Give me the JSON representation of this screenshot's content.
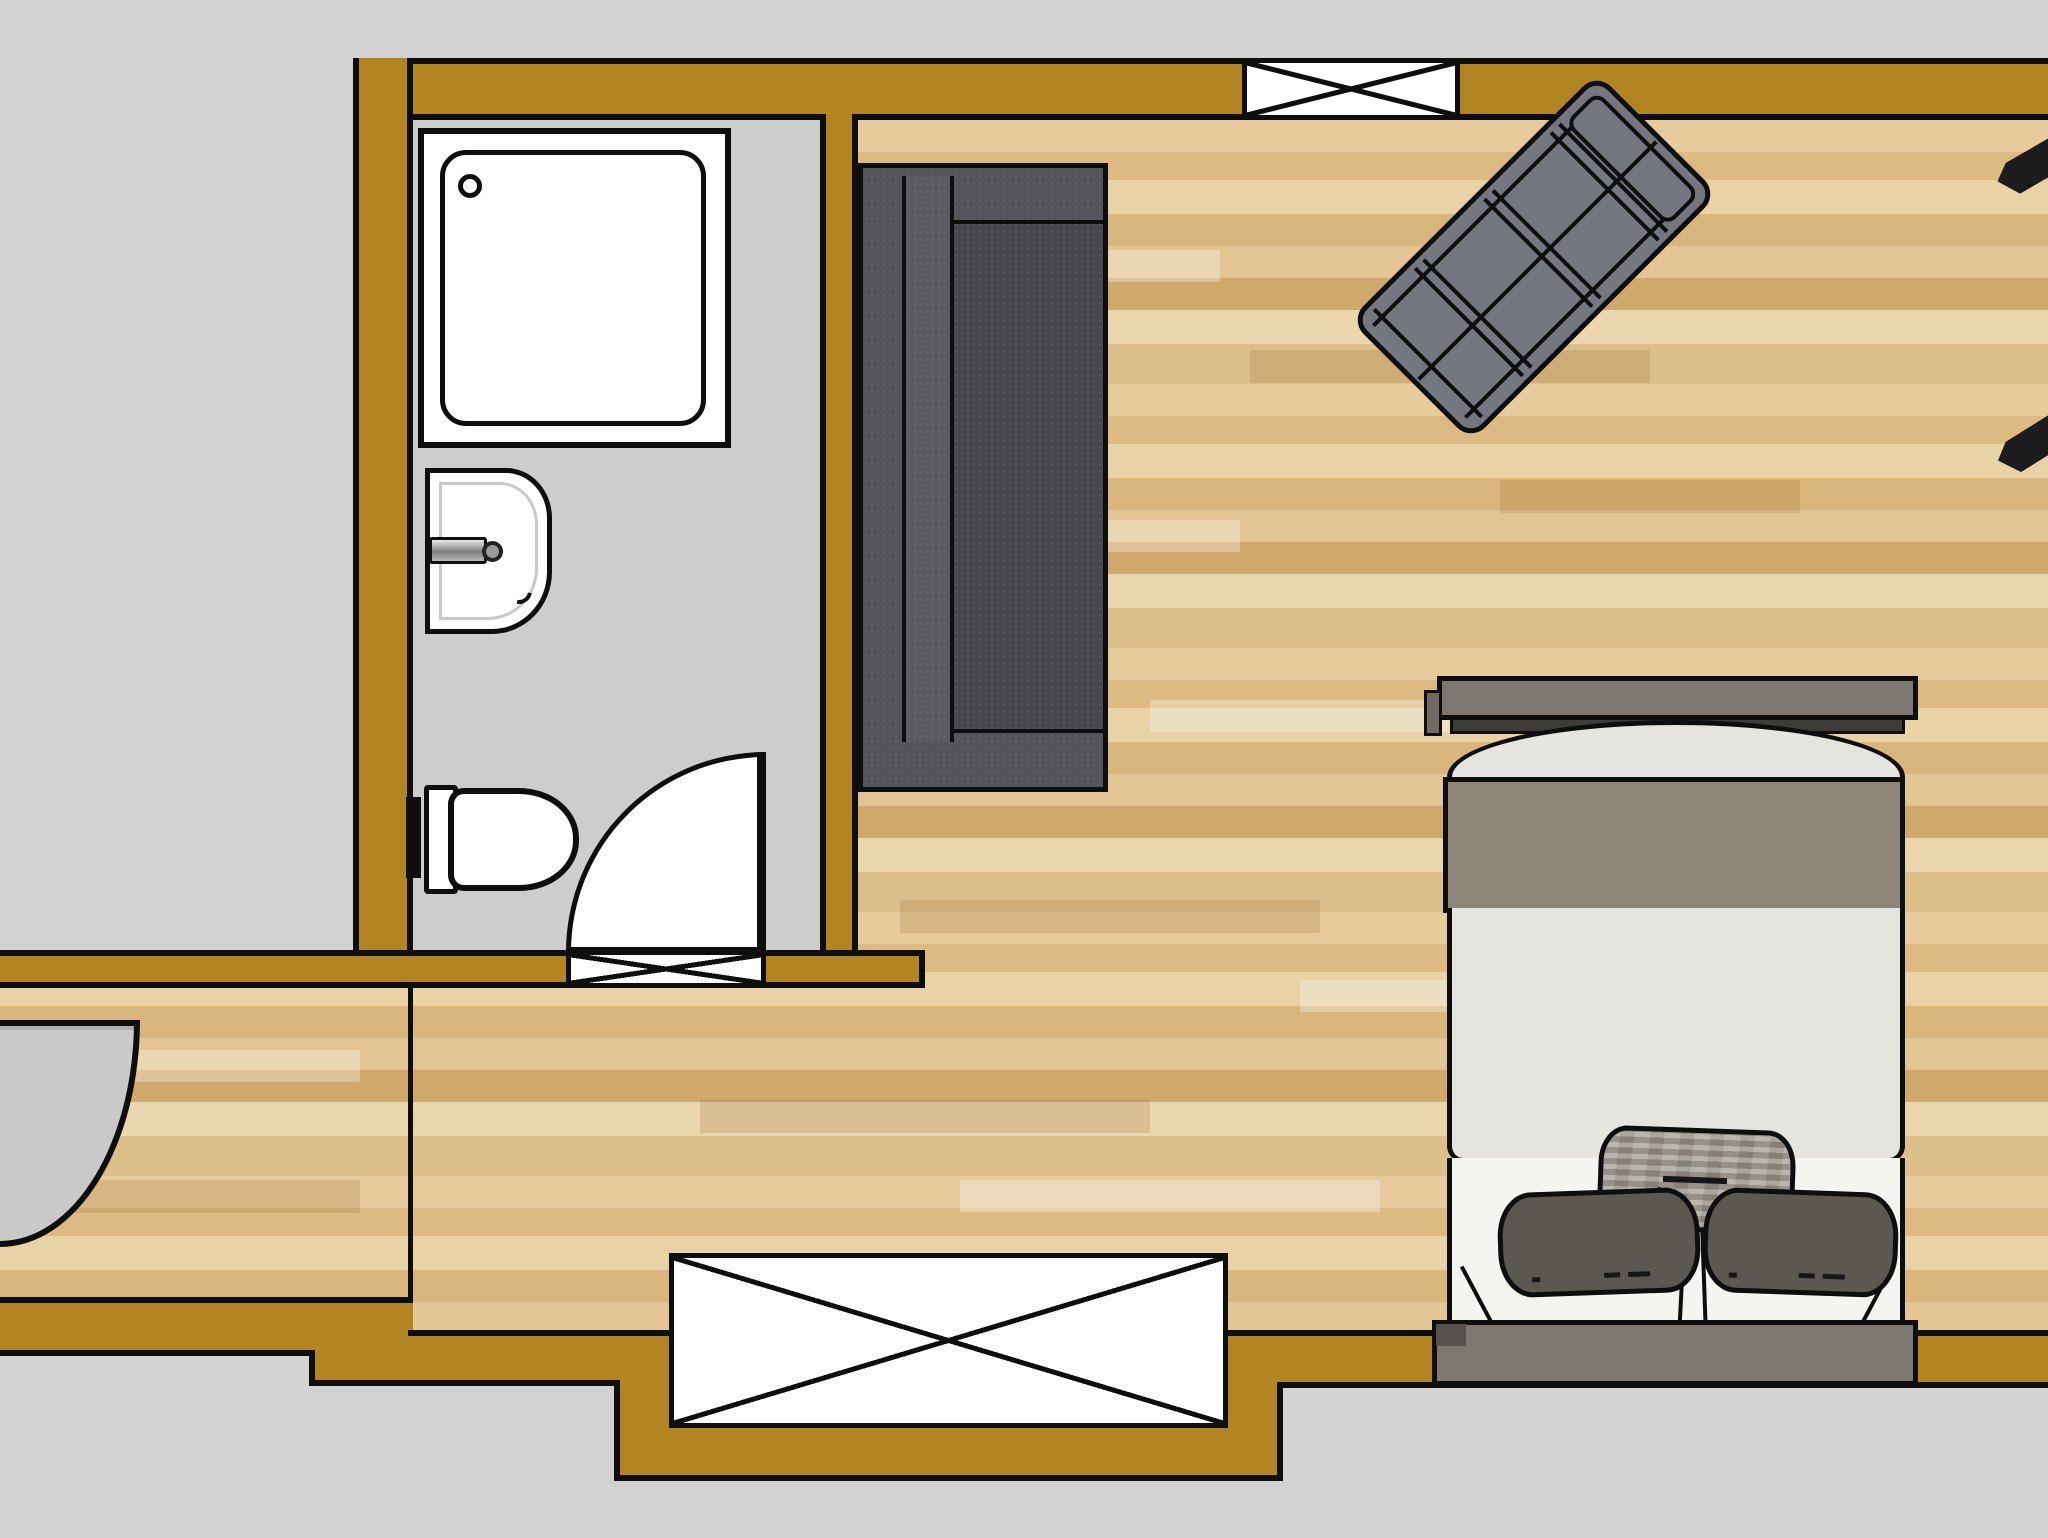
{
  "plan": {
    "type": "apartment-floor-plan-top-view",
    "rooms": [
      {
        "name": "bathroom",
        "floor": "gray-tile"
      },
      {
        "name": "main-room",
        "floor": "wood-parquet"
      },
      {
        "name": "hallway",
        "floor": "wood-parquet"
      }
    ],
    "openings": {
      "windows_count": 2,
      "doors_count": 2,
      "labels": {
        "window_top": "Window (top wall)",
        "window_bottom": "Window (bottom wall)",
        "bathroom_door": "Bathroom door with swing arc",
        "bathroom_threshold": "Bathroom door opening",
        "entrance_door": "Entrance door"
      }
    },
    "fixtures": {
      "shower": "Shower with tray and drain",
      "washbasin": "Washbasin with faucet",
      "toilet": "Toilet with flush plate"
    },
    "furniture": {
      "sofa": "Sofa (dark gray, top view)",
      "chaise": "Chaise longue (rotated 45°)",
      "bed": "Double bed with headboard and base bench",
      "pillow_center": "Patterned cushion",
      "pillow_left": "Dark pillow (left)",
      "pillow_right": "Dark pillow (right)",
      "cutoff_1": "Furniture edge cut off at right border",
      "cutoff_2": "Furniture edge cut off at right border"
    }
  },
  "colors": {
    "bg": "#d2d2d0",
    "wall": "#b28422",
    "ink": "#0e0e0e",
    "bathfloor": "#cdcdcb",
    "wood1": "#e7cb9d",
    "wood2": "#dcba82",
    "wood3": "#e9d2a6",
    "wood4": "#d8b67c",
    "wood5": "#e3c493",
    "wood6": "#cfa96b",
    "wood7": "#ecd6ad",
    "wood8": "#ddbf8b",
    "sofa1": "#46474b",
    "sofa2": "#53545a",
    "sofa3": "#5a5b61",
    "chaise": "#74777f",
    "bedframe": "#7d7872",
    "bedframedark": "#3f3c38",
    "bedband": "#8e857b",
    "duvet": "#e6e4df",
    "mattress": "#f4f4f1",
    "pillowdark": "#5b5852",
    "pillowlight1": "#a7a198",
    "pillowlight2": "#948d82",
    "doorslab": "#c9c9c7"
  }
}
